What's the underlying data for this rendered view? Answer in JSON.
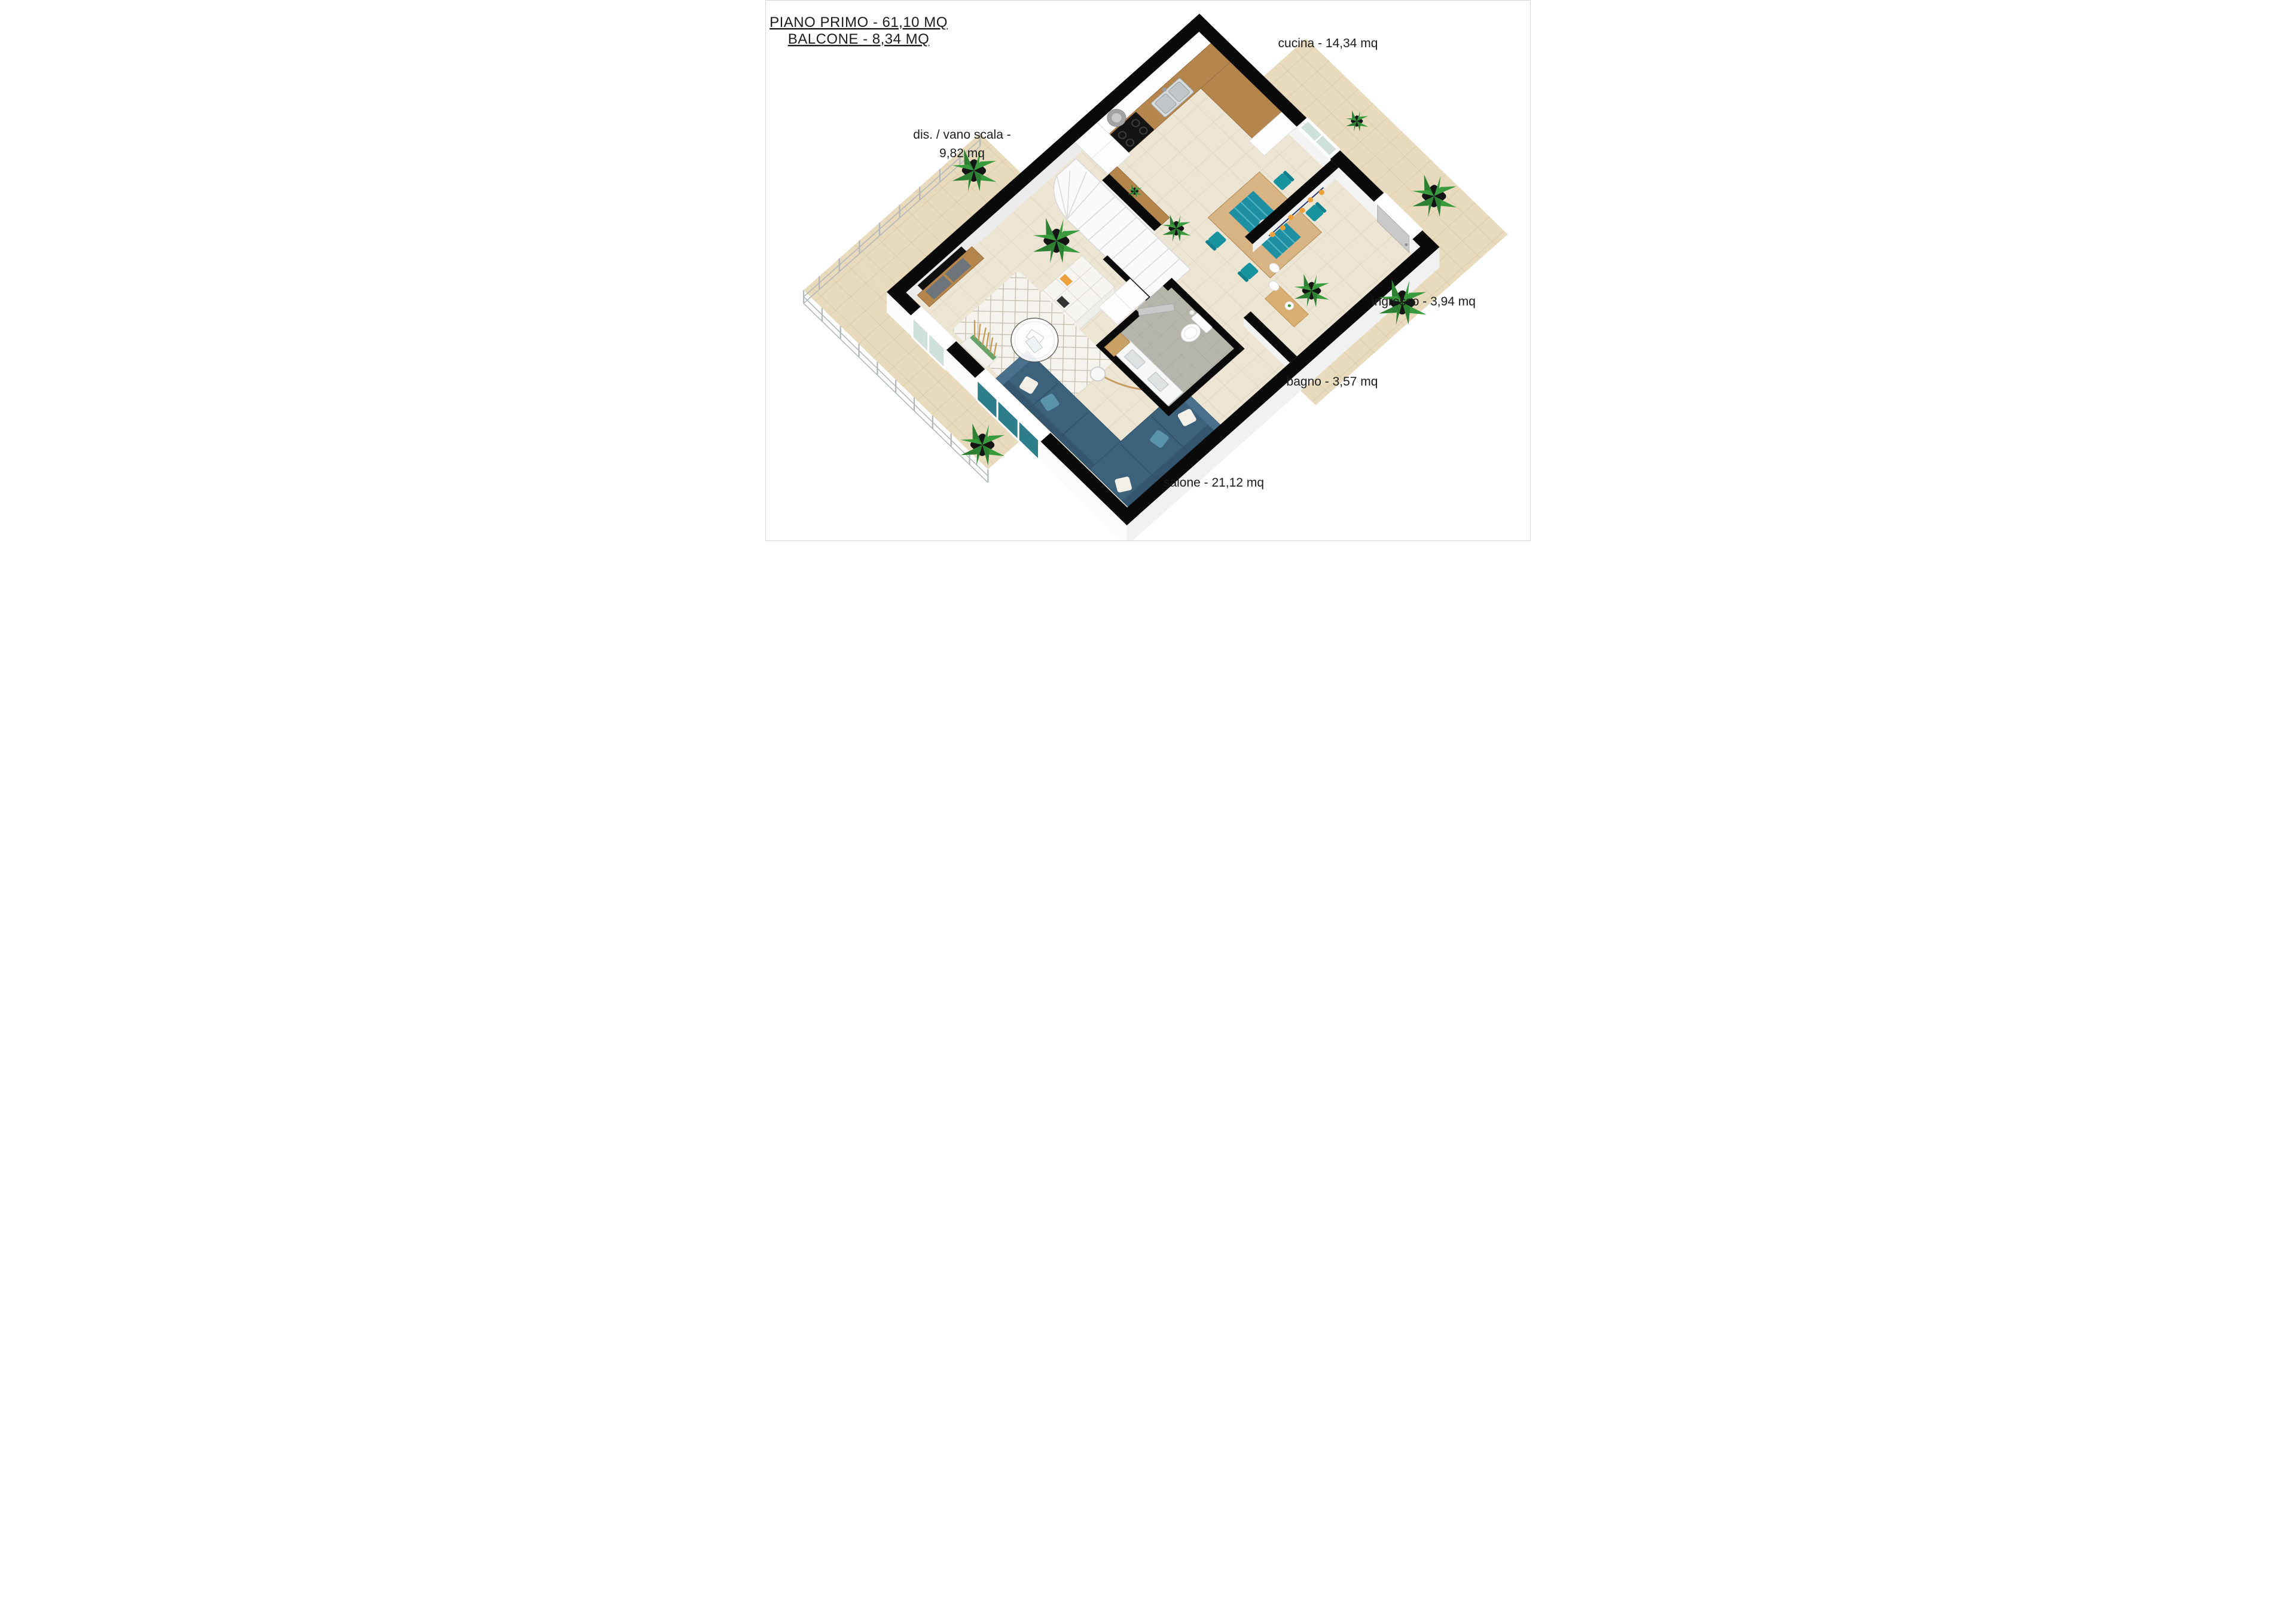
{
  "title": {
    "line1": "PIANO PRIMO - 61,10 MQ",
    "line2": "BALCONE - 8,34 MQ"
  },
  "floor_summary": {
    "name": "PIANO PRIMO",
    "area_mq": "61,10"
  },
  "balcony_summary": {
    "name": "BALCONE",
    "area_mq": "8,34"
  },
  "rooms": {
    "cucina": {
      "name": "cucina",
      "area_mq": "14,34",
      "label": "cucina - 14,34 mq"
    },
    "vano_scala": {
      "name": "dis. / vano scala",
      "area_mq": "9,82",
      "label_line1": "dis. / vano scala -",
      "label_line2": "9,82 mq"
    },
    "ingresso": {
      "name": "ingresso",
      "area_mq": "3,94",
      "label": "ingresso - 3,94 mq"
    },
    "bagno": {
      "name": "bagno",
      "area_mq": "3,57",
      "label": "bagno - 3,57 mq"
    },
    "salone": {
      "name": "salone",
      "area_mq": "21,12",
      "label": "salone - 21,12 mq"
    }
  },
  "colors": {
    "wall": "#0a0a0a",
    "floor": "#ece5d3",
    "floor-line": "#dbcfb6",
    "balcony": "#e8dbbd",
    "balcony-line": "#d2c2a0",
    "bath-floor": "#b5b5ac",
    "bath-line": "#a3a399",
    "wood": "#b5854e",
    "wood-light": "#d8b384",
    "teal": "#17929f",
    "runner": "#1f8fa3",
    "sofa": "#3c617b",
    "sofa-dark": "#2f5068",
    "rug": "#f5f3ed",
    "rug-line": "#c6bfb0",
    "stair": "#fafafa",
    "stair-edge": "#d9d9d9",
    "door-gray": "#c9c9c9",
    "glass": "#cfe0db",
    "glass-teal": "#2d7d8a",
    "plant": "#3a9b3e",
    "plant-dark": "#2e8133",
    "pot": "#141414",
    "steel": "#b2b7ba",
    "orange": "#eda13d",
    "navy": "#2a3a66",
    "tv": "#101010",
    "gray-furn": "#6d747a"
  }
}
